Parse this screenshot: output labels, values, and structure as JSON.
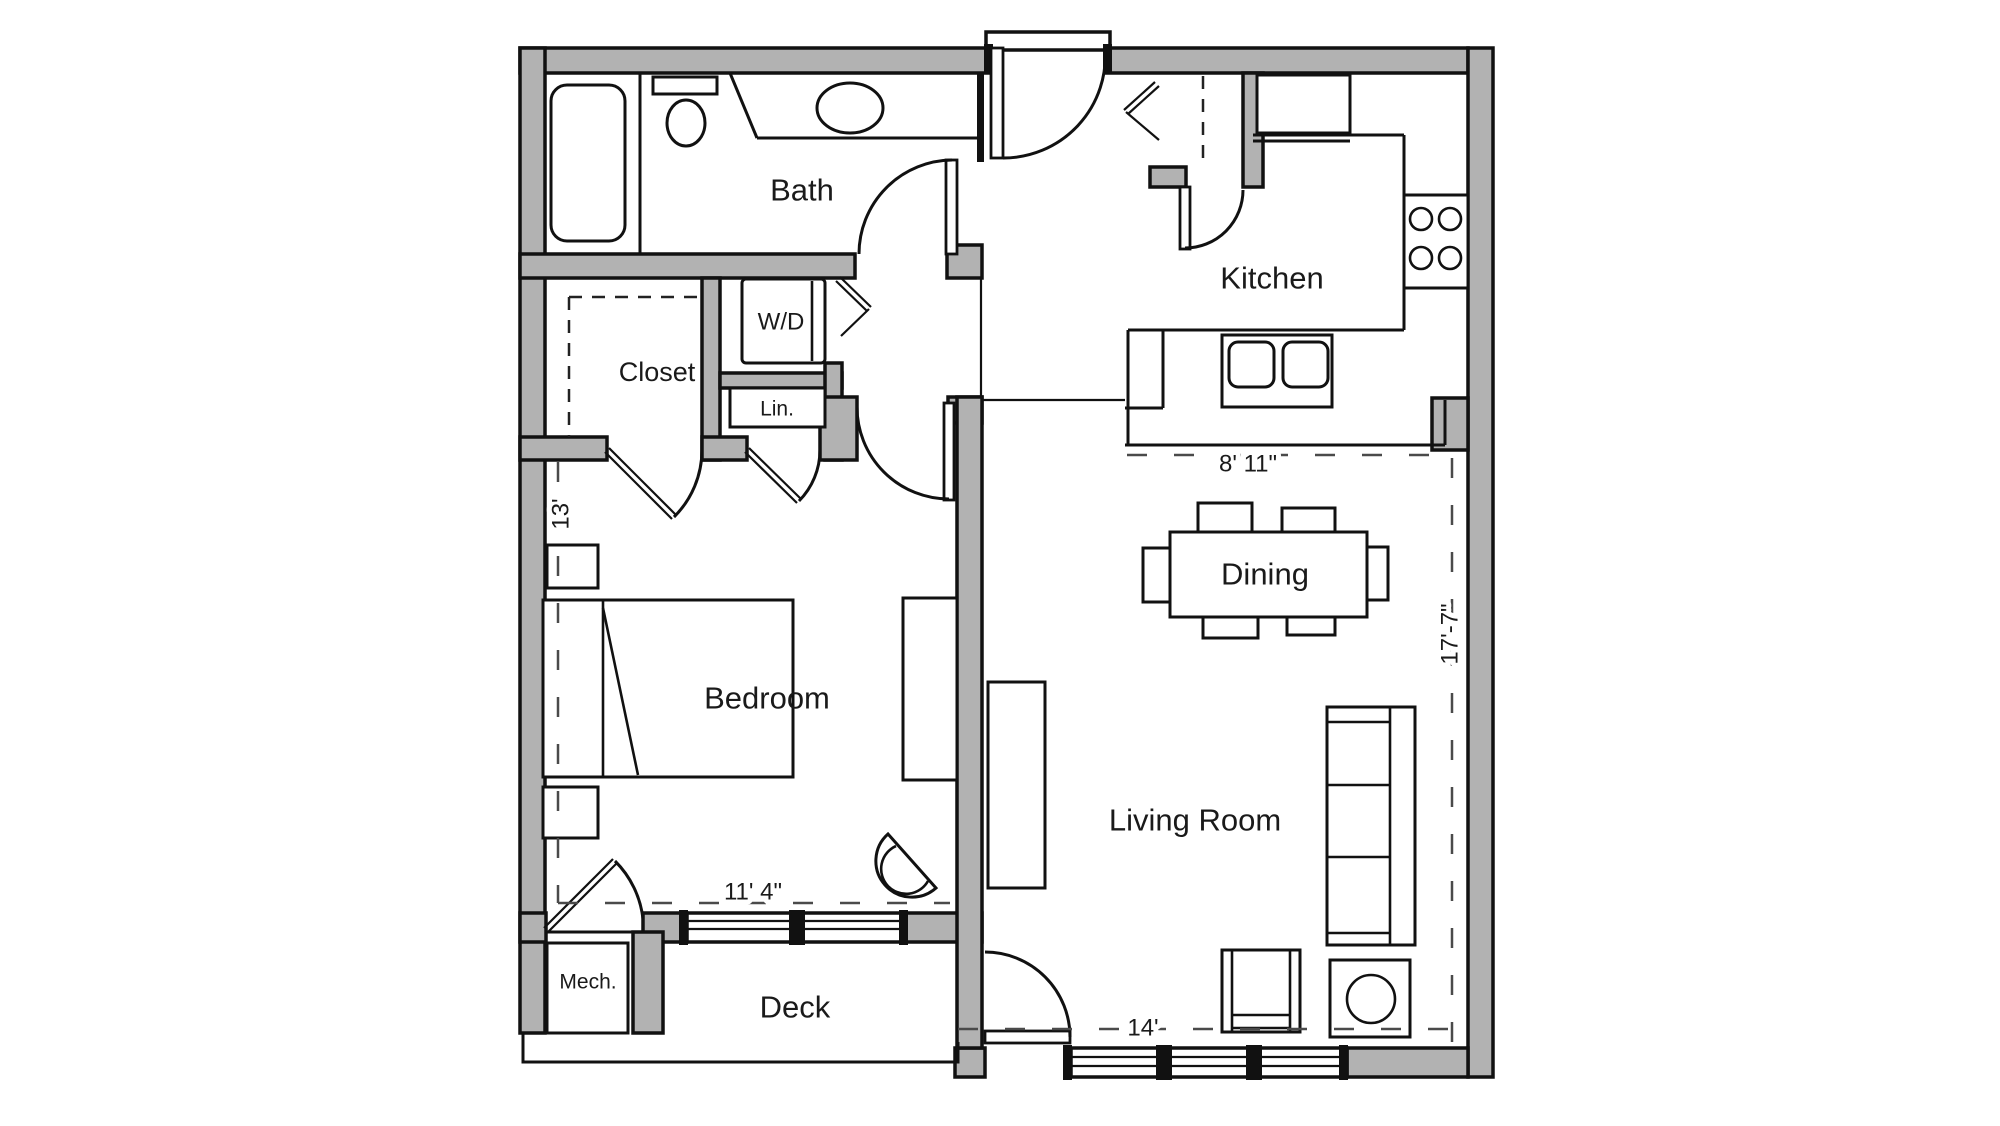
{
  "plan": {
    "type": "apartment-floor-plan",
    "wall_color": "#b2b2b2",
    "line_color": "#111111",
    "background": "#ffffff"
  },
  "rooms": {
    "bath": {
      "label": "Bath"
    },
    "kitchen": {
      "label": "Kitchen"
    },
    "closet": {
      "label": "Closet"
    },
    "washer_dryer": {
      "label": "W/D"
    },
    "linen": {
      "label": "Lin."
    },
    "bedroom": {
      "label": "Bedroom"
    },
    "dining": {
      "label": "Dining"
    },
    "living_room": {
      "label": "Living Room"
    },
    "deck": {
      "label": "Deck"
    },
    "mechanical": {
      "label": "Mech."
    }
  },
  "dimensions": {
    "kitchen_width": {
      "label": "8' 11\""
    },
    "living_height": {
      "label": "17'-7\""
    },
    "bedroom_depth": {
      "label": "13'"
    },
    "bedroom_width": {
      "label": "11' 4\""
    },
    "living_width": {
      "label": "14'"
    }
  }
}
